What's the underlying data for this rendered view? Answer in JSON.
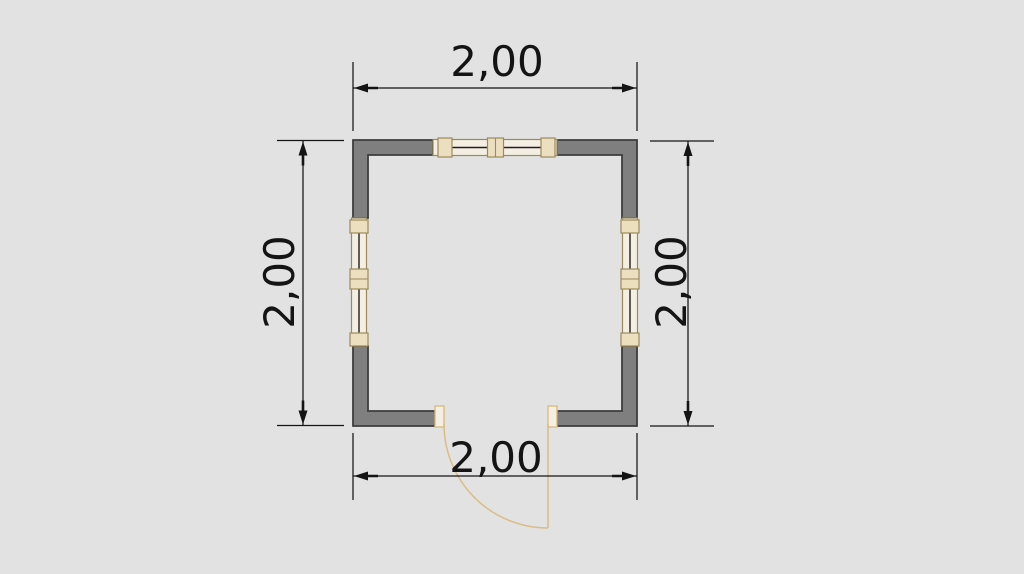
{
  "plan": {
    "dimension_labels": {
      "top": "2,00",
      "bottom": "2,00",
      "left": "2,00",
      "right": "2,00"
    }
  },
  "colors": {
    "background": "#e2e2e2",
    "wall_fill": "#7f7f7f",
    "wall_outline": "#3d3d3d",
    "dimension_ink": "#141414",
    "joinery_outline": "#9c8a5c",
    "joinery_fill": "#f4efe2",
    "mullion_fill": "#ecdfc0",
    "door_arc": "#d9bd85"
  }
}
